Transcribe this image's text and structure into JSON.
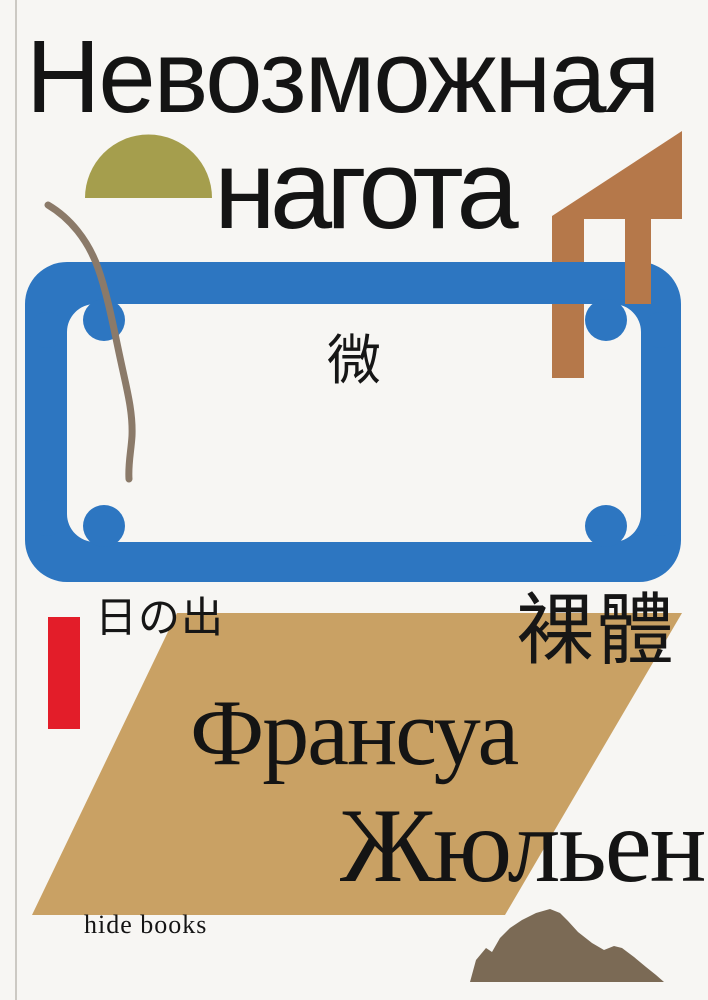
{
  "page": {
    "type": "book-cover"
  },
  "cover": {
    "title": {
      "line1": "Невозможная",
      "line2": "нагота"
    },
    "cjk": {
      "center": "微",
      "bottom_left": "日の出",
      "bottom_right": "裸體"
    },
    "author": {
      "line1": "Франсуа",
      "line2": "Жюльен"
    },
    "publisher": "hide books",
    "colors": {
      "background": "#f7f6f3",
      "text": "#141414",
      "frame_blue": "#2d76c1",
      "sun_olive": "#a59e4d",
      "house_rust": "#b5784a",
      "bar_red": "#e31d29",
      "parallelogram_tan": "#c9a164",
      "branch_brown": "#8b7a69",
      "mountain_taupe": "#7b6a55"
    },
    "shapes": [
      {
        "name": "sun-semicircle-shape",
        "color": "#a59e4d"
      },
      {
        "name": "house-shape",
        "color": "#b5784a"
      },
      {
        "name": "frame-shape",
        "color": "#2d76c1"
      },
      {
        "name": "branch-line-shape",
        "color": "#8b7a69"
      },
      {
        "name": "red-bar-shape",
        "color": "#e31d29"
      },
      {
        "name": "parallelogram-shape",
        "color": "#c9a164"
      },
      {
        "name": "mountain-shape",
        "color": "#7b6a55"
      }
    ]
  }
}
